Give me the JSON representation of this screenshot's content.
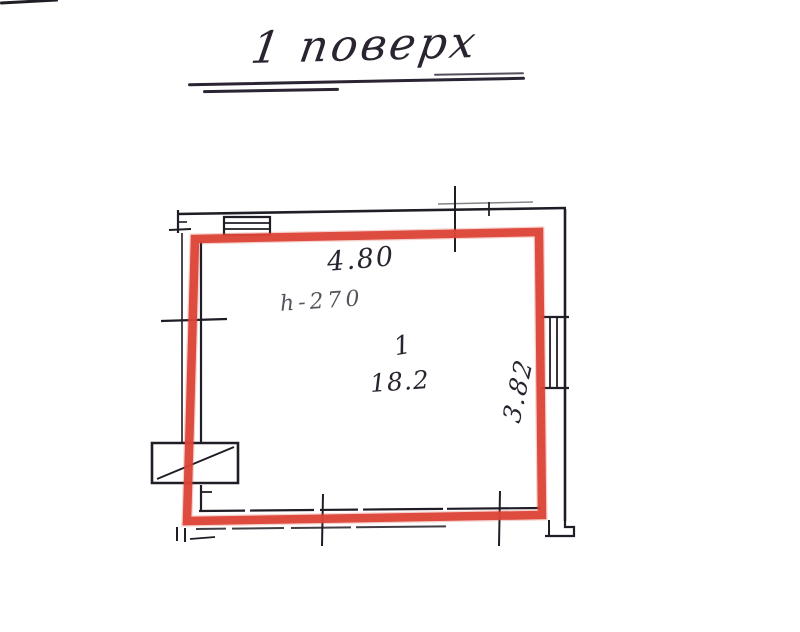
{
  "title": {
    "text": "1 поверх"
  },
  "room": {
    "width_dim": "4.80",
    "ceiling_height": "h-270",
    "number": "1",
    "area": "18.2",
    "depth_dim": "3.82"
  },
  "colors": {
    "outline_red": "#dc4337",
    "ink": "#211d26",
    "background": "#ffffff"
  }
}
